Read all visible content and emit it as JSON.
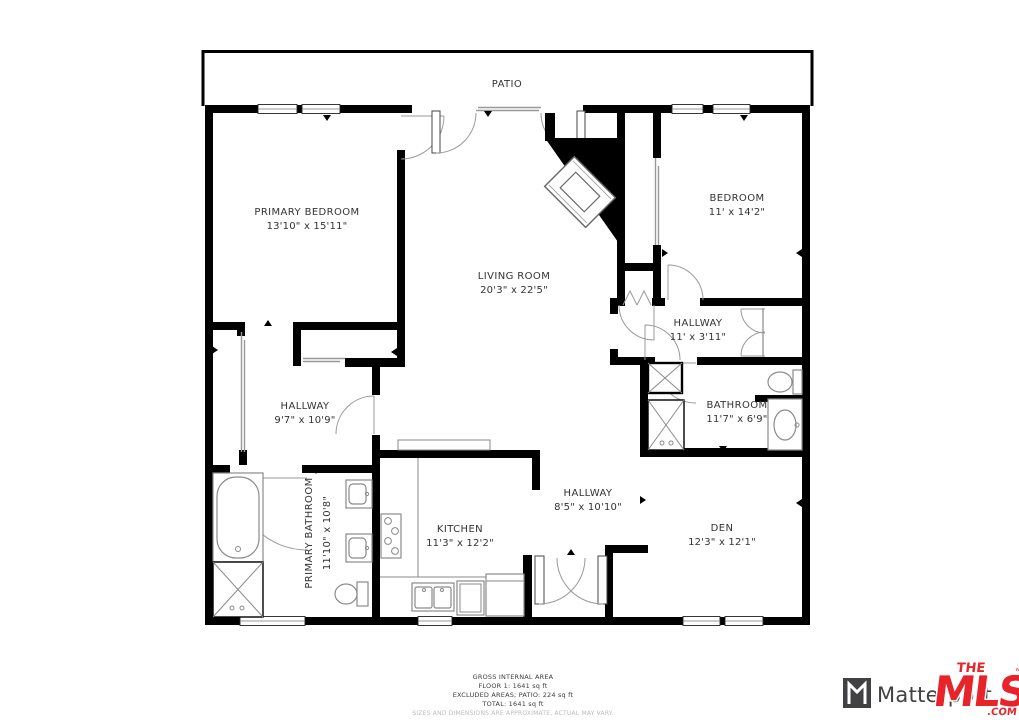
{
  "floorplan": {
    "patio": {
      "name": "PATIO"
    },
    "rooms": {
      "primary_bedroom": {
        "name": "PRIMARY BEDROOM",
        "dims": "13'10\" x 15'11\""
      },
      "bedroom": {
        "name": "BEDROOM",
        "dims": "11' x 14'2\""
      },
      "living_room": {
        "name": "LIVING ROOM",
        "dims": "20'3\" x 22'5\""
      },
      "hallway_upper": {
        "name": "HALLWAY",
        "dims": "11' x 3'11\""
      },
      "hallway_left": {
        "name": "HALLWAY",
        "dims": "9'7\" x 10'9\""
      },
      "bathroom": {
        "name": "BATHROOM",
        "dims": "11'7\" x 6'9\""
      },
      "primary_bathroom": {
        "name": "PRIMARY BATHROOM",
        "dims": "11'10\" x 10'8\""
      },
      "kitchen": {
        "name": "KITCHEN",
        "dims": "11'3\" x 12'2\""
      },
      "hallway_center": {
        "name": "HALLWAY",
        "dims": "8'5\" x 10'10\""
      },
      "den": {
        "name": "DEN",
        "dims": "12'3\" x 12'1\""
      }
    }
  },
  "footer": {
    "line1": "GROSS INTERNAL AREA",
    "line2": "FLOOR 1: 1641 sq ft",
    "line3": "EXCLUDED AREAS; PATIO: 224 sq ft",
    "line4": "TOTAL: 1641 sq ft",
    "disclaimer": "SIZES AND DIMENSIONS ARE APPROXIMATE, ACTUAL MAY VARY."
  },
  "branding": {
    "matterport": "Matterport",
    "themls": {
      "the": "THE",
      "mls": "MLS",
      "tm": "™",
      "com": ".COM"
    }
  },
  "colors": {
    "wall": "#000000",
    "fixture_gray": "#8a8a8a",
    "label": "#333333",
    "mls_red": "#e8242b",
    "matterport_gray": "#414042"
  }
}
